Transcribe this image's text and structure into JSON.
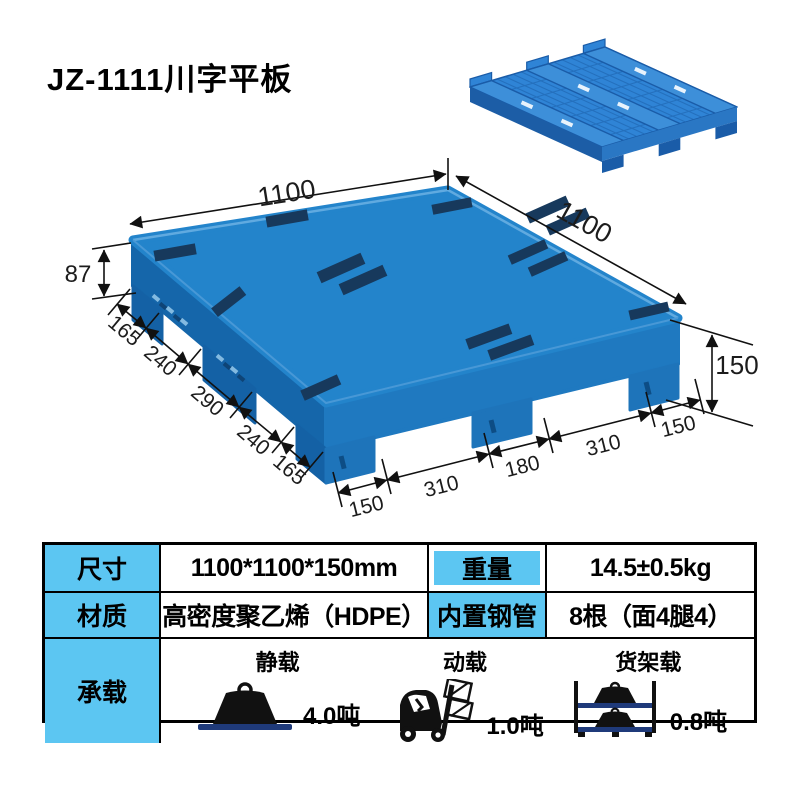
{
  "title": "JZ-1111川字平板",
  "diagram": {
    "top_left_length": "1100",
    "top_right_length": "1100",
    "deck_thickness": "87",
    "total_height": "150",
    "left_chain": [
      "165",
      "240",
      "290",
      "240",
      "165"
    ],
    "front_chain": [
      "150",
      "310",
      "180",
      "310",
      "150"
    ]
  },
  "table": {
    "row1": {
      "h1": "尺寸",
      "v1": "1100*1100*150mm",
      "h2": "重量",
      "v2": "14.5±0.5kg"
    },
    "row2": {
      "h1": "材质",
      "v1": "高密度聚乙烯（HDPE）",
      "h2": "内置钢管",
      "v2": "8根（面4腿4）"
    },
    "row3": {
      "header": "承载",
      "loads": [
        {
          "label": "静载",
          "value": "4.0吨",
          "icon": "weight-icon"
        },
        {
          "label": "动载",
          "value": "1.0吨",
          "icon": "forklift-icon"
        },
        {
          "label": "货架载",
          "value": "0.8吨",
          "icon": "rack-icon"
        }
      ]
    }
  },
  "colors": {
    "pallet_blue": "#2384cb",
    "pallet_dark_face": "#1566aa",
    "antislip_strip": "#17395c",
    "table_header_bg": "#5cc6f2",
    "shelf_navy": "#1f3a7a"
  }
}
